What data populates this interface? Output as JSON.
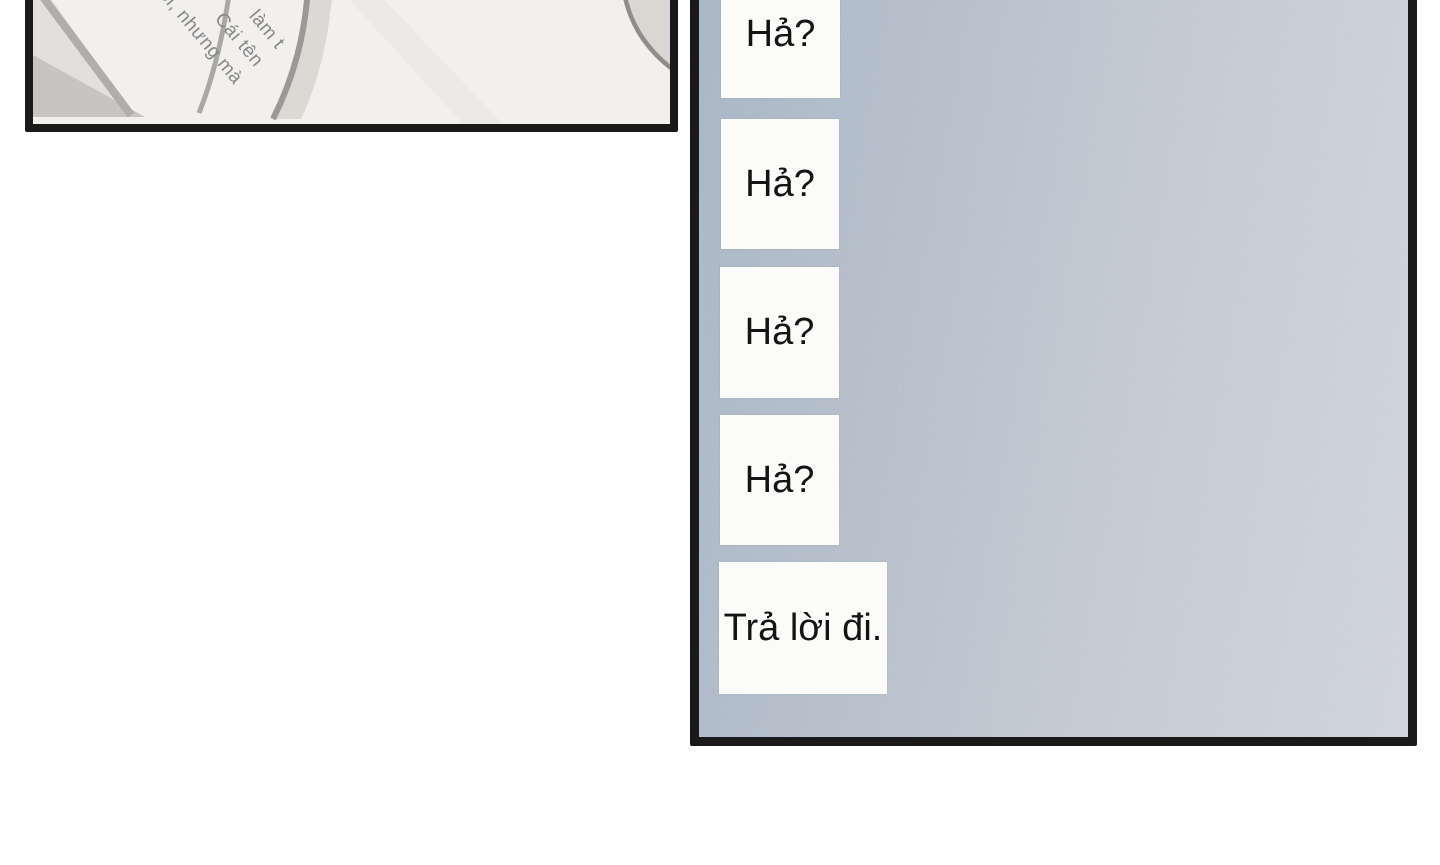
{
  "page": {
    "background_color": "#ffffff",
    "panel_border_color": "#1a1a1a"
  },
  "left_panel": {
    "artwork_background": "#f1f0ed",
    "artwork_description": "close-up-of-fabric-and-straps",
    "caption": {
      "rotation_deg": 50,
      "color": "#85878a",
      "lines": [
        "làm t",
        "Cái tên",
        "ồi, nhưng mà"
      ]
    }
  },
  "right_panel": {
    "background_left_color": "#a9b7c7",
    "background_right_color": "#d4d9de",
    "bubble_background": "#fbfbfa",
    "text_color": "#141414",
    "bubbles": [
      {
        "text": "Hả?"
      },
      {
        "text": "Hả?"
      },
      {
        "text": "Hả?"
      },
      {
        "text": "Hả?"
      },
      {
        "text": "Trả lời đi."
      }
    ]
  }
}
